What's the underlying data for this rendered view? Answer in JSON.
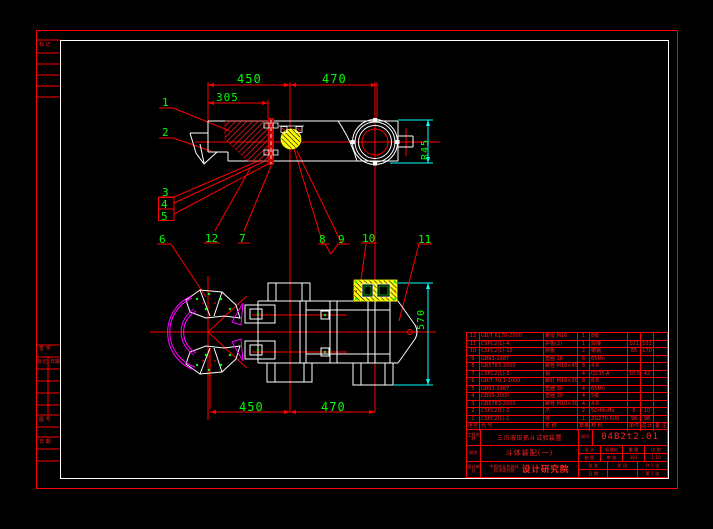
{
  "colors": {
    "background": "#000000",
    "frame_red": "#ff0000",
    "frame_white": "#ffffff",
    "dimension_green": "#00ff00",
    "dimension_cyan": "#00ffff",
    "phantom_magenta": "#ff00ff",
    "hatch_yellow": "#ffff00",
    "table_text_red": "#ff2222"
  },
  "dims": {
    "top_450": "450",
    "top_470": "470",
    "top_305": "305",
    "r45": "R45",
    "bottom_450": "450",
    "bottom_470": "470",
    "right_570": "570"
  },
  "callouts": [
    "1",
    "2",
    "3",
    "4",
    "5",
    "6",
    "7",
    "8",
    "9",
    "10",
    "11",
    "12"
  ],
  "parts_list": {
    "headers": [
      "序号",
      "代  号",
      "名  称",
      "数量",
      "材  料",
      "单件",
      "总计",
      "备 注"
    ],
    "rows": [
      [
        "12",
        "GB/T 6170-2000",
        "螺母 M16",
        "1",
        "8级",
        "",
        "",
        ""
      ],
      [
        "11",
        "CSPC2(1)-4",
        "护板(2)",
        "1",
        "焊接",
        "101",
        "101",
        ""
      ],
      [
        "10",
        "CSPC2(1)-10",
        "侧板",
        "2",
        "铸钢",
        "85",
        "170",
        ""
      ],
      [
        "9",
        "GB93-1987",
        "垫圈 16",
        "8",
        "65Mn",
        "",
        "",
        ""
      ],
      [
        "8",
        "GB5783-2000",
        "螺栓 M16×45",
        "8",
        "4.8",
        "",
        "",
        ""
      ],
      [
        "7",
        "CSPC2(1)-3",
        "销",
        "4",
        "Q235-A",
        "10.5",
        "42",
        ""
      ],
      [
        "6",
        "GB/T 70.1-2000",
        "螺钉 M16×30",
        "8",
        "8.8",
        "",
        "",
        ""
      ],
      [
        "5",
        "GB93-1987",
        "垫圈 30",
        "4",
        "65Mn",
        "",
        "",
        ""
      ],
      [
        "4",
        "GB95-2000",
        "垫圈 30",
        "4",
        "5级",
        "",
        "",
        ""
      ],
      [
        "3",
        "GB5783-2000",
        "螺栓 M10×30",
        "4",
        "4.8",
        "",
        "",
        ""
      ],
      [
        "2",
        "CSPC2(1)-2",
        "爪",
        "2",
        "5CrMnMo",
        "5",
        "10",
        ""
      ],
      [
        "1",
        "CSPC2(1)-1",
        "体",
        "1",
        "ZG270-500",
        "98",
        "98",
        ""
      ]
    ]
  },
  "title_block": {
    "project_label": "工程名称",
    "project_name": "三爪液压抓斗试验装置",
    "dno_label": "图号",
    "drawing_no": "04B2t2.01",
    "name_label": "图名",
    "drawing_name": "斗体装配(一)",
    "unit_label": "设计单位",
    "company_line1": "中国农业机械化",
    "company_line2": "科学研究院",
    "company_big": "设计研究院",
    "grid1": [
      [
        "设 计",
        "标准化",
        "重 量",
        "比 例"
      ],
      [
        "制 图",
        "审 核",
        "391",
        "1:10"
      ]
    ],
    "grid2": [
      [
        "批 准",
        "阶 段",
        "共 1 张"
      ],
      [
        "日 期",
        "",
        "第 1 张"
      ]
    ]
  },
  "left_strip": {
    "top": "标 记",
    "s1": "签 字",
    "s2a": "标记",
    "s2b": "日期",
    "s3": "图 号",
    "s4": "日 期"
  }
}
